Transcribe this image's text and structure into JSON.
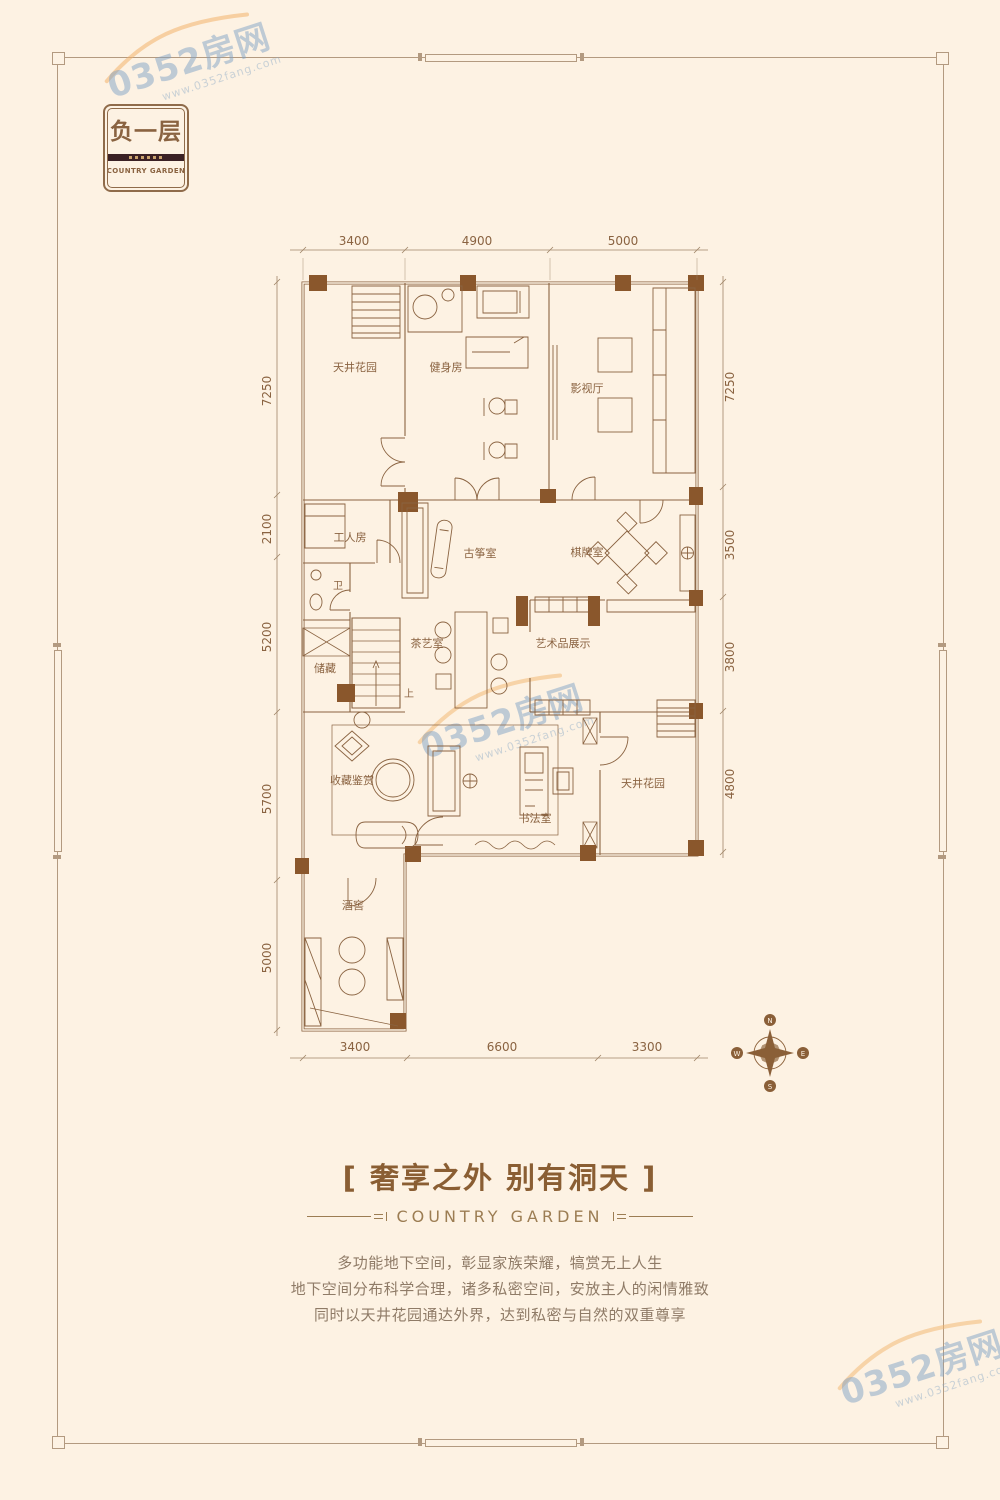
{
  "badge": {
    "title": "负一层",
    "subtitle": "COUNTRY GARDEN"
  },
  "watermark": {
    "text": "0352房网",
    "subtext": "www.0352fang.com"
  },
  "plan": {
    "dims_top": [
      "3400",
      "4900",
      "5000"
    ],
    "dims_bottom": [
      "3400",
      "6600",
      "3300"
    ],
    "dims_left": [
      "7250",
      "2100",
      "5200",
      "5700",
      "5000"
    ],
    "dims_right": [
      "7250",
      "3500",
      "3800",
      "4800"
    ],
    "rooms": {
      "garden_top": "天井花园",
      "gym": "健身房",
      "theater": "影视厅",
      "worker": "工人房",
      "bath": "卫",
      "guzheng": "古筝室",
      "chess": "棋牌室",
      "tea": "茶艺室",
      "art": "艺术品展示",
      "storage": "储藏",
      "stairs_up": "上",
      "collection": "收藏鉴赏",
      "calligraphy": "书法室",
      "garden_bottom": "天井花园",
      "wine": "酒窖"
    },
    "compass": {
      "n": "N",
      "e": "E",
      "s": "S",
      "w": "W"
    }
  },
  "footer": {
    "headline": "[ 奢享之外 别有洞天 ]",
    "brand": "COUNTRY GARDEN",
    "lines": [
      "多功能地下空间，彰显家族荣耀，犒赏无上人生",
      "地下空间分布科学合理，诸多私密空间，安放主人的闲情雅致",
      "同时以天井花园通达外界，达到私密与自然的双重尊享"
    ]
  },
  "colors": {
    "background": "#fdf2e3",
    "plan_line": "#8a6341",
    "column_fill": "#8a572c",
    "headline": "#8a5e33",
    "brand": "#9c7d53",
    "body_text": "#8f7b67",
    "watermark_blue": "#7fa2c5",
    "watermark_orange": "#f2b36b"
  }
}
